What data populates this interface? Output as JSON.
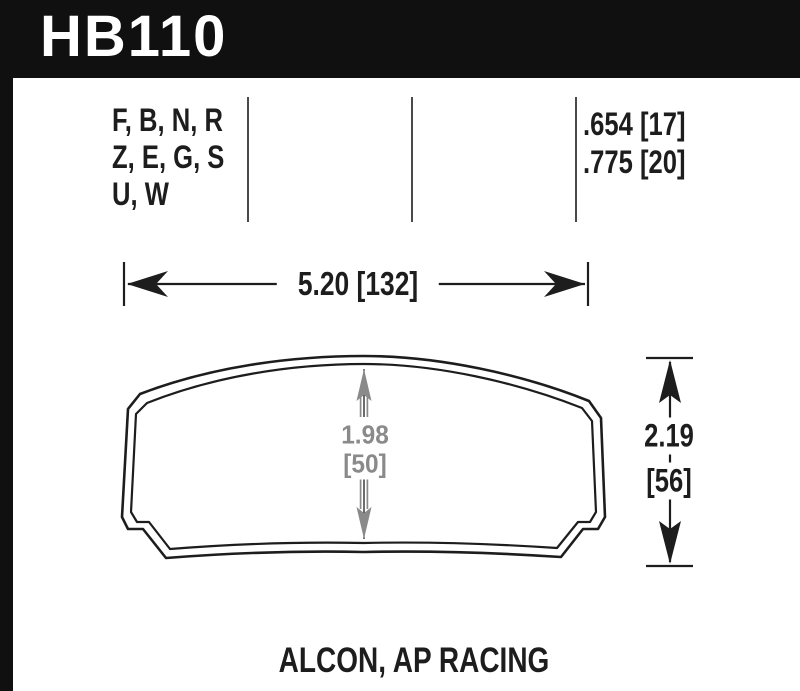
{
  "part": {
    "number": "HB110"
  },
  "spec_row": {
    "compound_lines": [
      "F, B, N, R",
      "Z, E, G, S",
      "U, W"
    ],
    "thickness_lines": [
      ".654 [17]",
      ".775 [20]"
    ]
  },
  "dimensions": {
    "overall_width": "5.20 [132]",
    "pad_center_height_in": "1.98",
    "pad_center_height_mm": "[50]",
    "overall_height_in": "2.19",
    "overall_height_mm": "[56]"
  },
  "footer": {
    "applications": "ALCON, AP RACING"
  },
  "colors": {
    "ink": "#1d1d1d",
    "header_bg": "#101010",
    "dim_gray": "#8a8a8a",
    "paper": "#ffffff"
  }
}
